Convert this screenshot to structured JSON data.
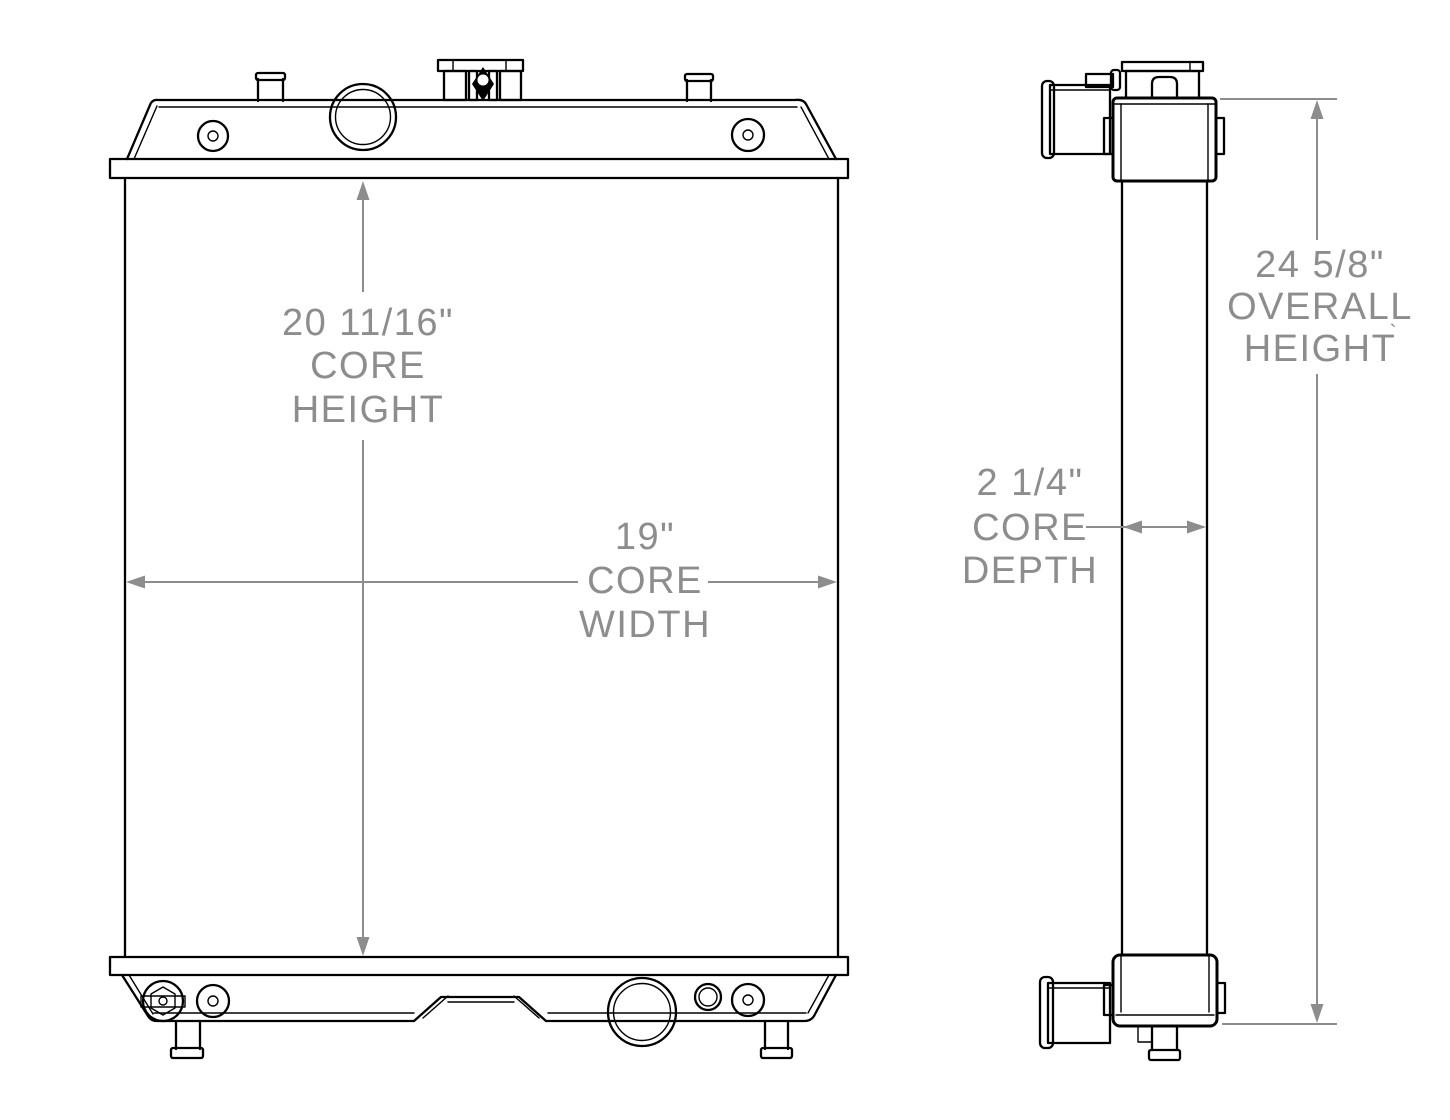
{
  "colors": {
    "outline": "#000000",
    "dimension": "#8d8d8d",
    "background": "#ffffff"
  },
  "labels": {
    "core_height": [
      "20 11/16\"",
      "CORE",
      "HEIGHT"
    ],
    "core_width": [
      "19\"",
      "CORE",
      "WIDTH"
    ],
    "core_depth": [
      "2 1/4\"",
      "CORE",
      "DEPTH"
    ],
    "overall_height": [
      "24 5/8\"",
      "OVERALL",
      "HEIGHT"
    ],
    "stray_mark": "`"
  }
}
